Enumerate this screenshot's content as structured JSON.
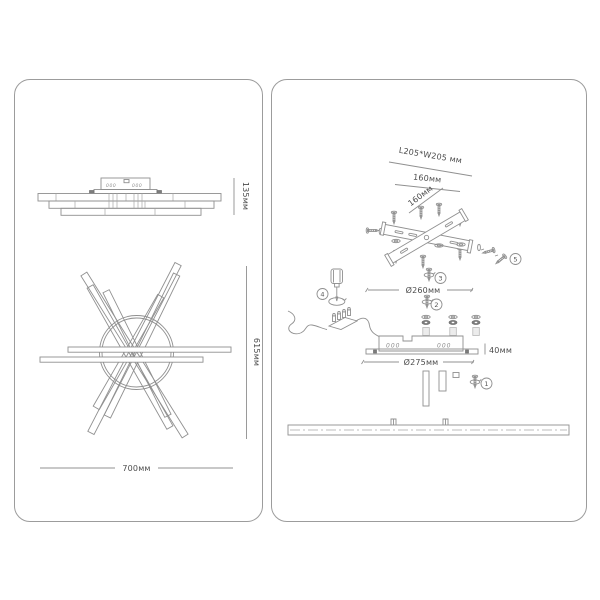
{
  "colors": {
    "line": "#909090",
    "panel_border": "#9c9c9c",
    "text": "#4c4c4c",
    "background": "#ffffff"
  },
  "left_panel": {
    "side_view": {
      "dim_height": "135мм",
      "vents_left": "000",
      "vents_right": "000"
    },
    "top_view": {
      "dim_height": "615мм",
      "dim_width": "700мм"
    }
  },
  "right_panel": {
    "bracket": {
      "dim_plate": "L205*W205 мм",
      "dim_spacing_h": "160мм",
      "dim_spacing_d": "160мм",
      "dim_diameter": "Ø260мм"
    },
    "canopy": {
      "dim_height": "40мм",
      "dim_diameter": "Ø275мм",
      "vents_left": "000",
      "vents_right": "000"
    },
    "steps": [
      "1",
      "2",
      "3",
      "4",
      "5"
    ]
  }
}
